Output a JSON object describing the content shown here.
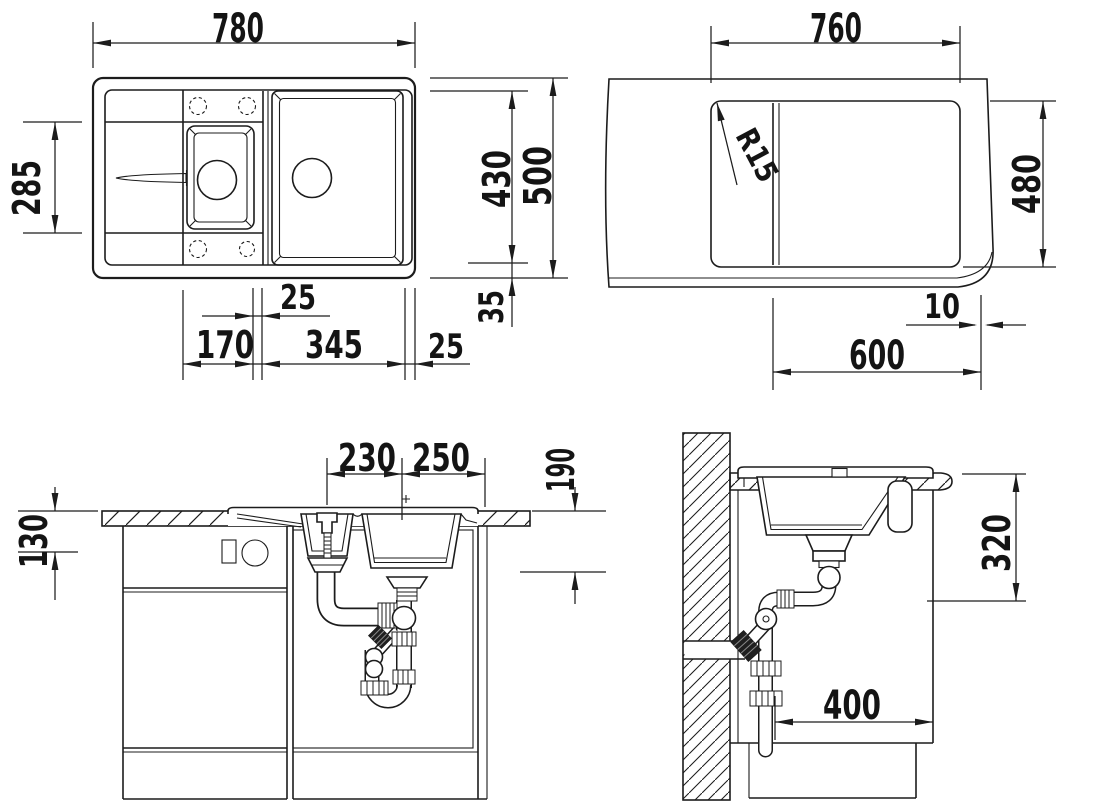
{
  "drawing": {
    "title": "sink-installation-technical-drawing",
    "background": "#ffffff",
    "line_color": "#1c1c1c",
    "views": {
      "plan": {
        "label": "sink-top-view",
        "dims": {
          "overall_width": "780",
          "left_depth": "285",
          "inner_depth": "430",
          "overall_depth": "500",
          "bottom_offset": "35",
          "divider_width": "25",
          "small_bowl_width": "170",
          "large_bowl_width": "345",
          "right_offset": "25"
        }
      },
      "cutout": {
        "label": "worktop-cutout-view",
        "dims": {
          "cutout_width": "760",
          "corner_radius": "R15",
          "cutout_depth": "480",
          "edge_gap": "10",
          "cabinet_width": "600"
        }
      },
      "front": {
        "label": "front-section-view",
        "dims": {
          "drain_spacing": "230",
          "drain_to_edge": "250",
          "depth_below_top": "190",
          "apron_height": "130"
        }
      },
      "side": {
        "label": "side-section-view",
        "dims": {
          "under_top_clearance": "320",
          "trap_to_front": "400"
        }
      }
    }
  }
}
